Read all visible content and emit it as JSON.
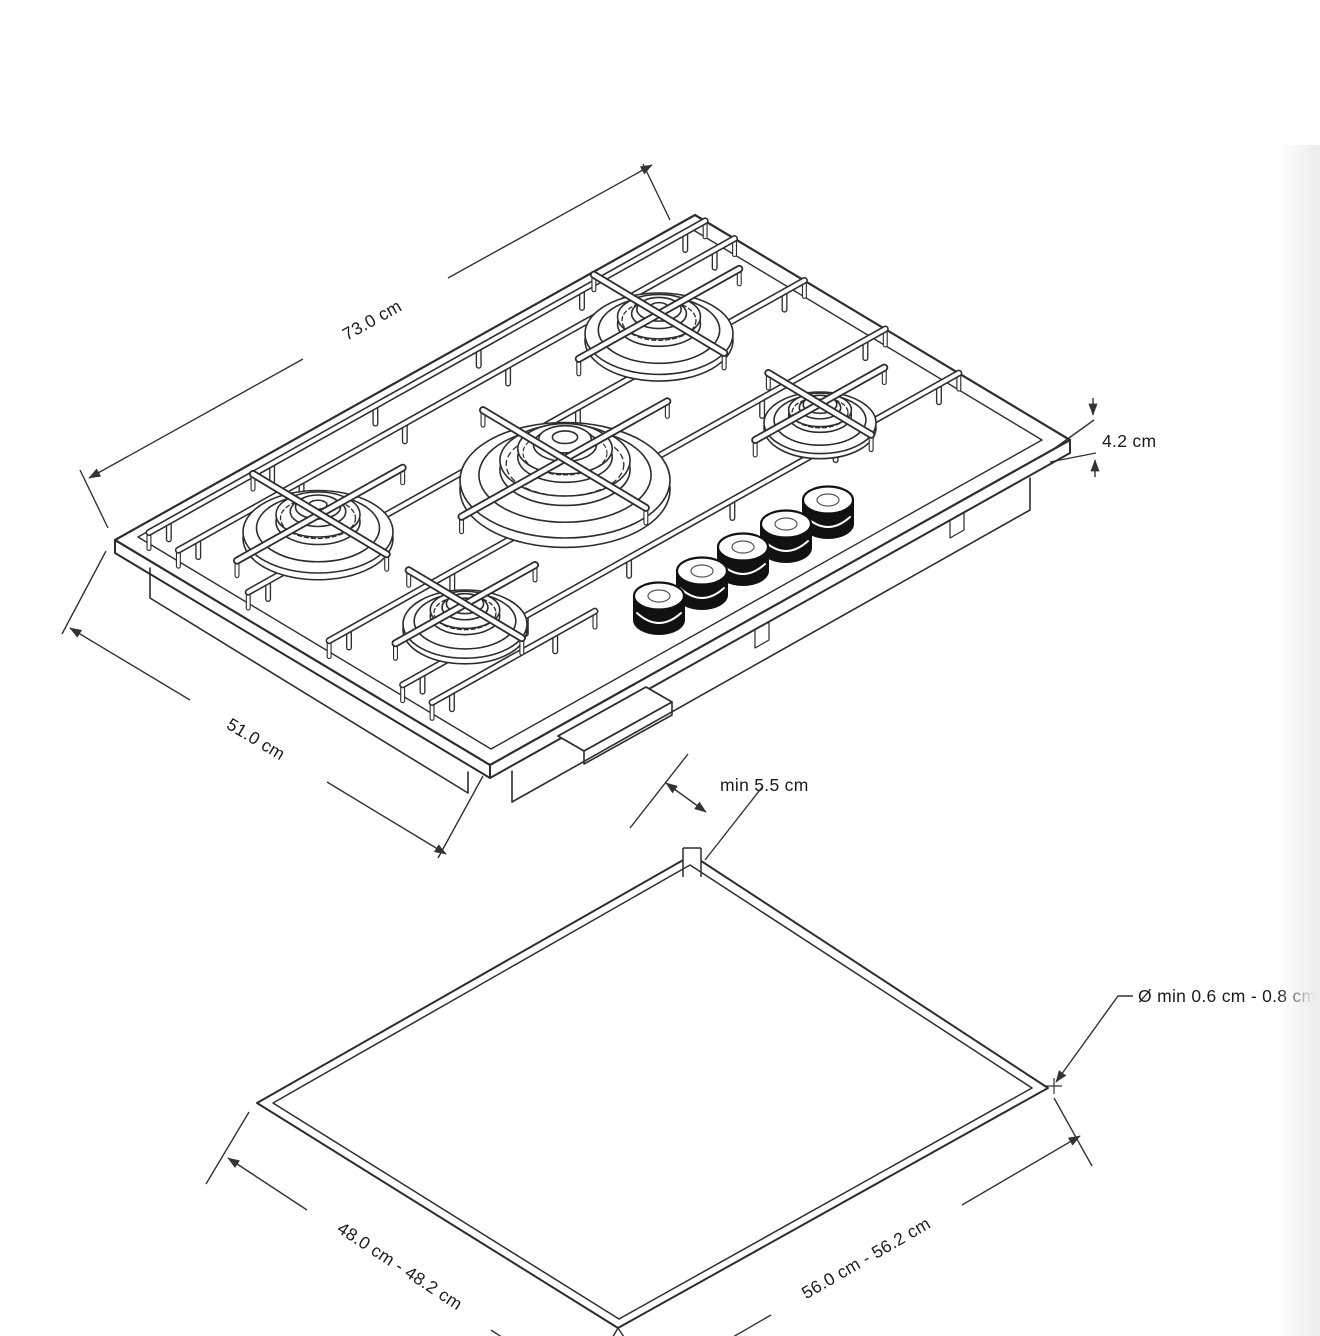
{
  "page": {
    "background": "#ffffff",
    "ink_color": "#2d2d2d"
  },
  "drawing": {
    "cooktop": {
      "burner_count": 5,
      "knob_count": 5,
      "width_label": "73.0 cm",
      "depth_label": "51.0 cm",
      "height_label": "4.2 cm"
    },
    "cutout": {
      "clearance_label": "min 5.5 cm",
      "hole_label": "Ø min 0.6 cm - 0.8 cm",
      "depth_label": "48.0 cm - 48.2 cm",
      "width_label": "56.0 cm - 56.2 cm"
    }
  }
}
